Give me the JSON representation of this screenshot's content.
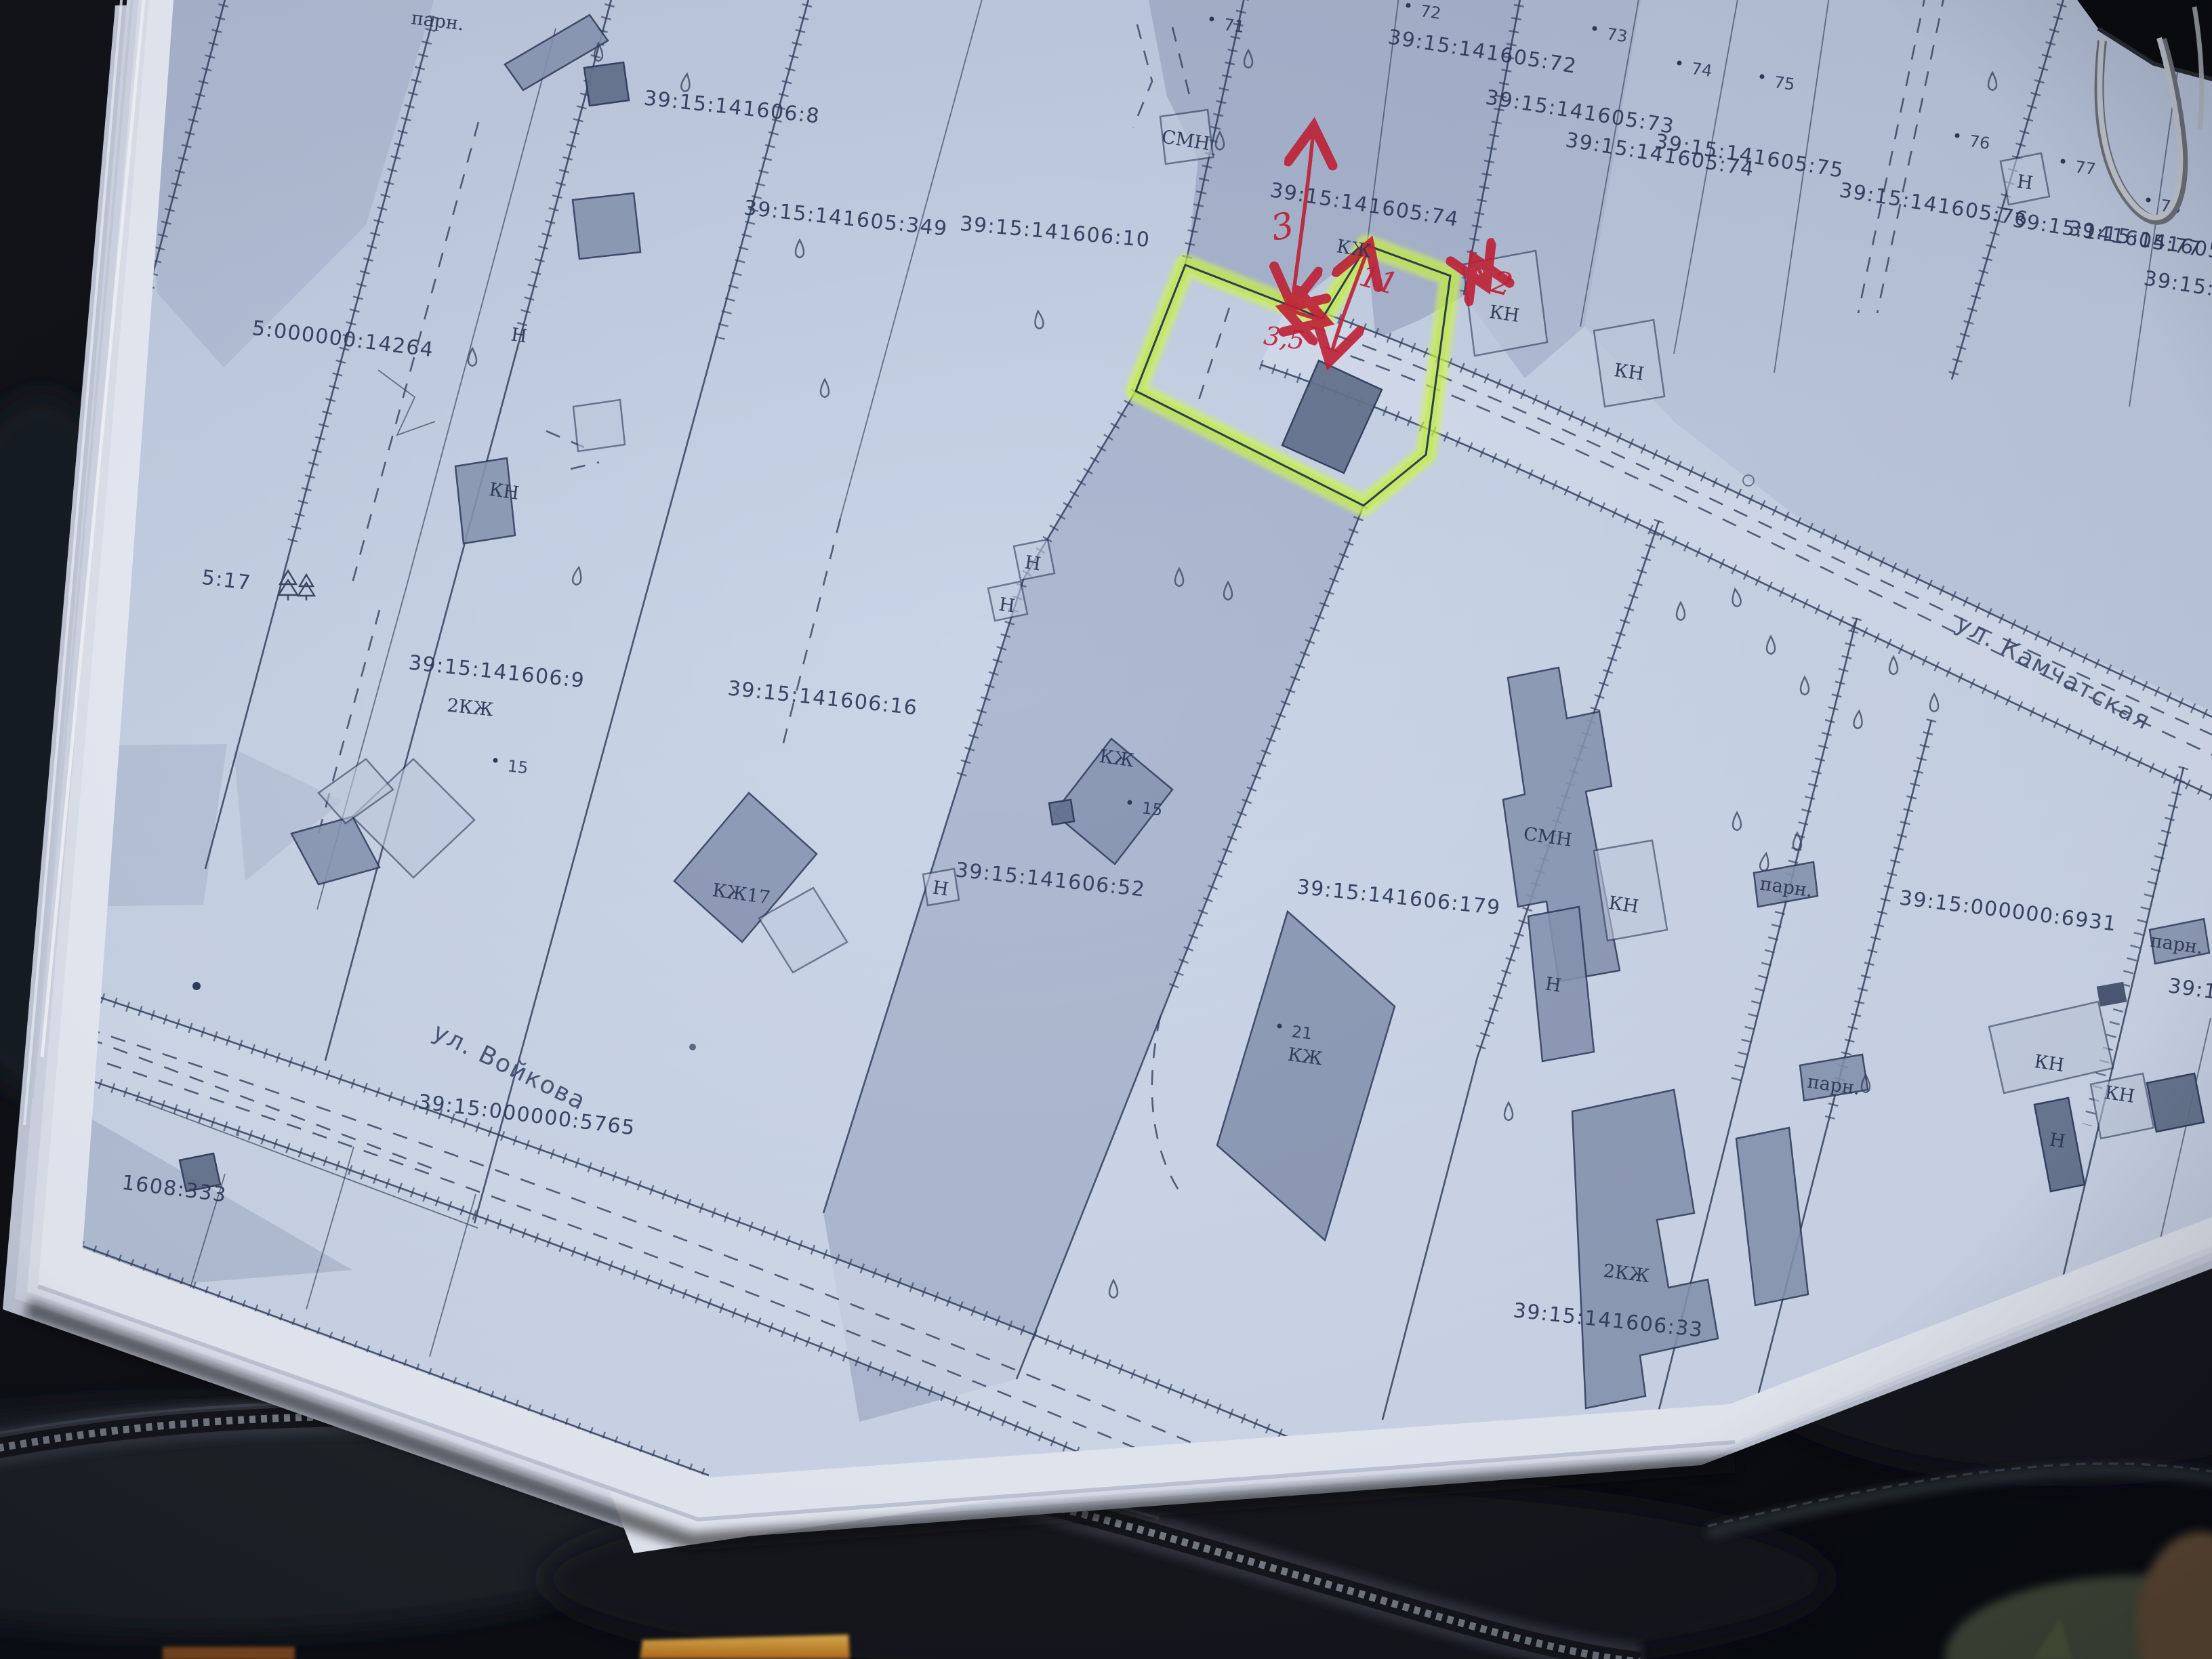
{
  "colors": {
    "highlighter": "#c9f53c",
    "red_ink": "#c22136",
    "map_line": "#33415f",
    "print_background": "#c7d2e6",
    "paper": "#e9edf6",
    "case": "#0d0f13"
  },
  "streets": [
    {
      "label": "ул. Камчатская"
    },
    {
      "label": "ул. Войкова"
    }
  ],
  "measurements": [
    {
      "value": "3"
    },
    {
      "value": "11"
    },
    {
      "value": "3,5"
    },
    {
      "value": "2"
    }
  ],
  "parcels": [
    {
      "number": "39:15:141606:8"
    },
    {
      "number": "39:15:141605:349"
    },
    {
      "number": "39:15:141606:10"
    },
    {
      "number": "39:15:141605:74"
    },
    {
      "number": "39:15:141605:72"
    },
    {
      "number": "39:15:141605:73"
    },
    {
      "number": "39:15:141605:74"
    },
    {
      "number": "39:15:141605:75"
    },
    {
      "number": "39:15:141605:76"
    },
    {
      "number": "39:15:141605:77"
    },
    {
      "number": "39:15:141605:78"
    },
    {
      "number": "39:15:14"
    },
    {
      "number": "5:000000:14264"
    },
    {
      "number": "39:15:141606:9"
    },
    {
      "number": "39:15:141606:16"
    },
    {
      "number": "39:15:141606:52"
    },
    {
      "number": "39:15:141606:179"
    },
    {
      "number": "39:15:000000:6931"
    },
    {
      "number": "39:15:000000:5765"
    },
    {
      "number": "39:15:141606:33"
    },
    {
      "number": "5:17"
    },
    {
      "number": "1608:333"
    },
    {
      "number": "39:15:0"
    }
  ],
  "buildings": [
    {
      "code": "КЖ"
    },
    {
      "code": "СМН"
    },
    {
      "code": "КН"
    },
    {
      "code": "КН"
    },
    {
      "code": "КН"
    },
    {
      "code": "Н"
    },
    {
      "code": "Н"
    },
    {
      "code": "Н"
    },
    {
      "code": "Н"
    },
    {
      "code": "Н"
    },
    {
      "code": "КЖ17"
    },
    {
      "code": "КЖ"
    },
    {
      "code": "2КЖ"
    },
    {
      "code": "СМН"
    },
    {
      "code": "КН"
    },
    {
      "code": "парн."
    },
    {
      "code": "парн."
    },
    {
      "code": "парн."
    },
    {
      "code": "парн."
    },
    {
      "code": "КЖ"
    },
    {
      "code": "Н"
    },
    {
      "code": "2КЖ"
    },
    {
      "code": "КН"
    },
    {
      "code": "КН"
    },
    {
      "code": "Н"
    }
  ],
  "points": [
    {
      "n": "71"
    },
    {
      "n": "72"
    },
    {
      "n": "73"
    },
    {
      "n": "74"
    },
    {
      "n": "75"
    },
    {
      "n": "76"
    },
    {
      "n": "77"
    },
    {
      "n": "78"
    },
    {
      "n": "15"
    },
    {
      "n": "15"
    },
    {
      "n": "21"
    }
  ]
}
